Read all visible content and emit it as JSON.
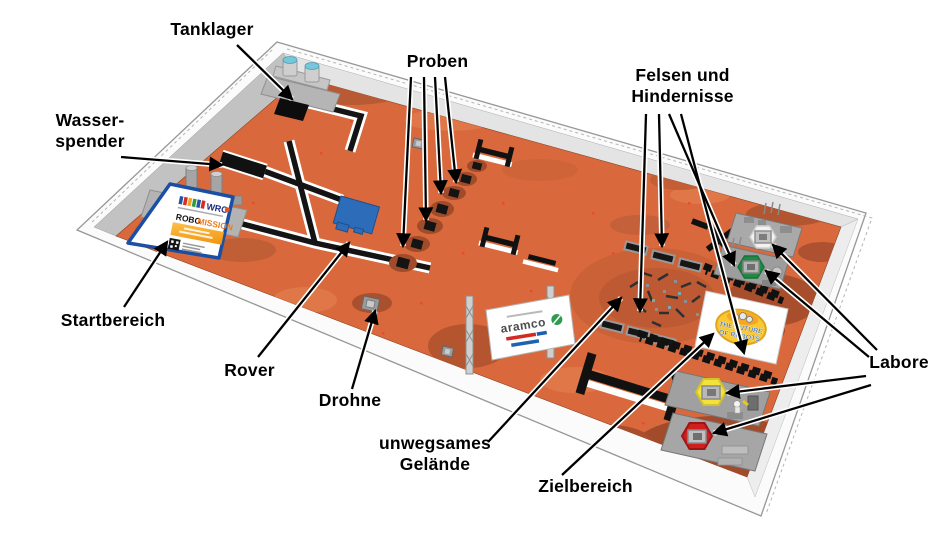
{
  "annotations": {
    "tanklager": "Tanklager",
    "wasserspender": "Wasser-\nspender",
    "proben": "Proben",
    "felsen_hindernisse": "Felsen und\nHindernisse",
    "startbereich": "Startbereich",
    "rover": "Rover",
    "drohne": "Drohne",
    "unwegsames_gelaende": "unwegsames\nGelände",
    "zielbereich": "Zielbereich",
    "labore": "Labore"
  },
  "mat_signs": {
    "wro_logo": "WRO",
    "robo": "ROBO",
    "mission": "MISSION",
    "aramco": "aramco",
    "future_line1": "THE FUTURE",
    "future_line2": "OF ROBOTS"
  },
  "colors": {
    "mat": "#D9693C",
    "rover_blue": "#2D6CB8",
    "lab_white": "#F2F2F2",
    "lab_green": "#1F8A43",
    "lab_yellow": "#F3E13C",
    "lab_red": "#CF1F1F",
    "start_card_border": "#1B4FA4",
    "mission_orange": "#F07D1A"
  }
}
